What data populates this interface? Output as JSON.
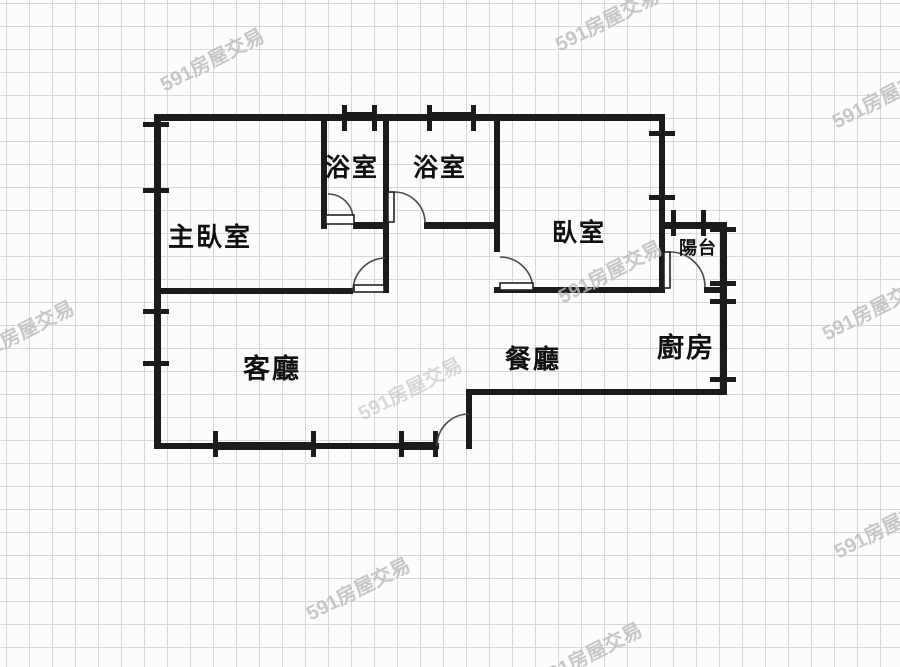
{
  "watermark": {
    "text": "591房屋交易"
  },
  "floor_plan": {
    "rooms": {
      "master_bedroom": {
        "label": "主臥室"
      },
      "bathroom_1": {
        "label": "浴室"
      },
      "bathroom_2": {
        "label": "浴室"
      },
      "bedroom": {
        "label": "臥室"
      },
      "balcony": {
        "label": "陽台"
      },
      "living_room": {
        "label": "客廳"
      },
      "dining_room": {
        "label": "餐廳"
      },
      "kitchen": {
        "label": "廚房"
      }
    },
    "colors": {
      "wall": "#1b1b1b",
      "grid": "#d8d8d8",
      "background": "#fcfcfc",
      "door_arc": "#4a4a4a",
      "watermark": "#bcbcbc"
    }
  }
}
